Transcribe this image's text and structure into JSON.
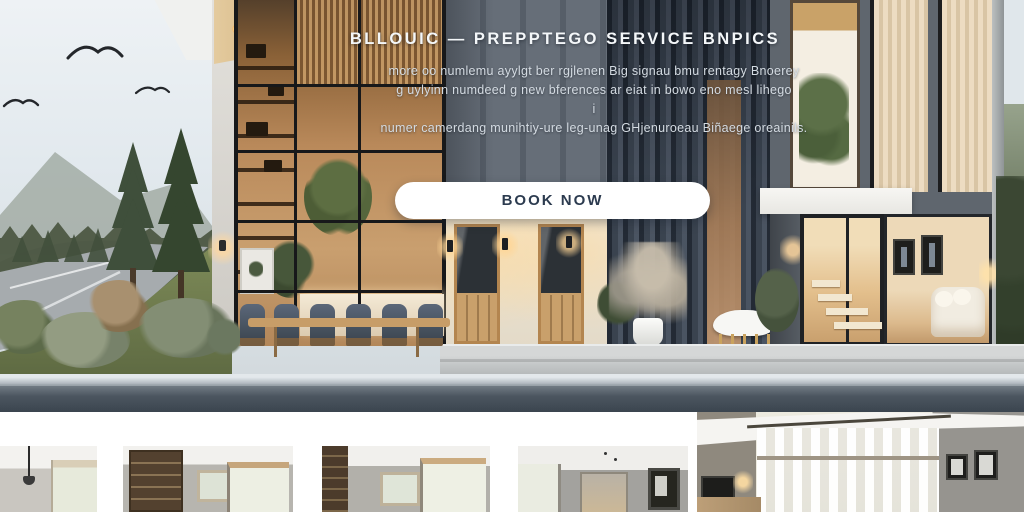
{
  "hero": {
    "heading": "BLLOUIC — PREPPTEGO SERVICE BNPICS",
    "tagline_lines": [
      "more oo numlemu ayylgt ber rgjlenen Big signau bmu rentagy Bnoerey",
      "g uylyinn numdeed g new bferences ar eiat in bowo eno mesl lihego",
      "i",
      "numer camerdang munihtiy-ure leg-unag GHjenuroeau Biñaege oreainils."
    ],
    "cta": {
      "label": "BOOK NOW"
    }
  },
  "icons": {
    "bird-icon": "double-arc wing glyph (svg stroke)",
    "recessed-light-icon": "warm radial dot",
    "wall-sconce-icon": "small dark rectangle with warm glow"
  },
  "colors": {
    "cta_background": "#ffffff",
    "cta_text": "#2c3b4f",
    "street_bar": "#4b555f",
    "sky": "#e4eaee",
    "grass": "#75824f",
    "slat_wall": "#39424e",
    "warm_wood": "#c59c6a",
    "gallery_background": "#ffffff"
  }
}
